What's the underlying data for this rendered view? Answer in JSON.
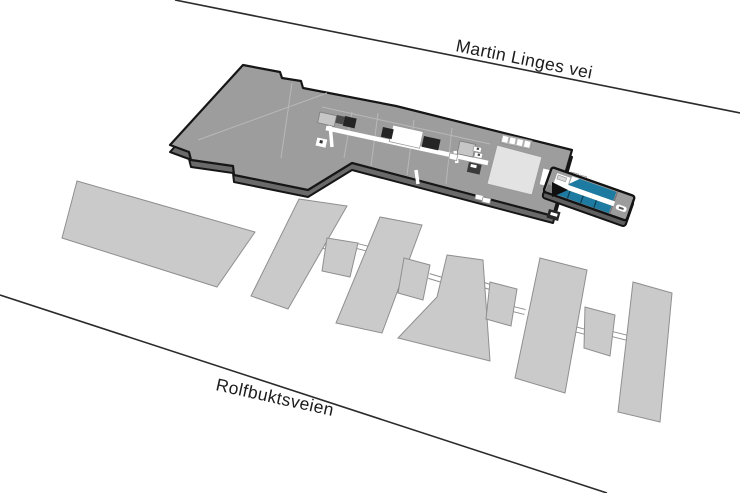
{
  "map": {
    "street_top_label": "Martin Linges vei",
    "street_bottom_label": "Rolfbuktsveien"
  },
  "legend": {
    "main_building": "main-building-floorplan",
    "highlighted_rooms": "blue-highlighted-rooms",
    "neighbor_buildings": "neighbor-building-blocks"
  },
  "colors": {
    "bg": "#ffffff",
    "street_line": "#2b2b2b",
    "street_text": "#1c1c1c",
    "building_top": "#9d9d9d",
    "building_side": "#6a6a6a",
    "outline": "#161616",
    "divider": "#b8b8b8",
    "corridor": "#ffffff",
    "dark_room": "#242424",
    "hall_fill": "#e3e3e3",
    "highlight_blue": "#1d7ba1",
    "highlight_dark": "#0d3d52",
    "neighbor_fill": "#cacaca",
    "neighbor_stroke": "#8f8f8f"
  }
}
